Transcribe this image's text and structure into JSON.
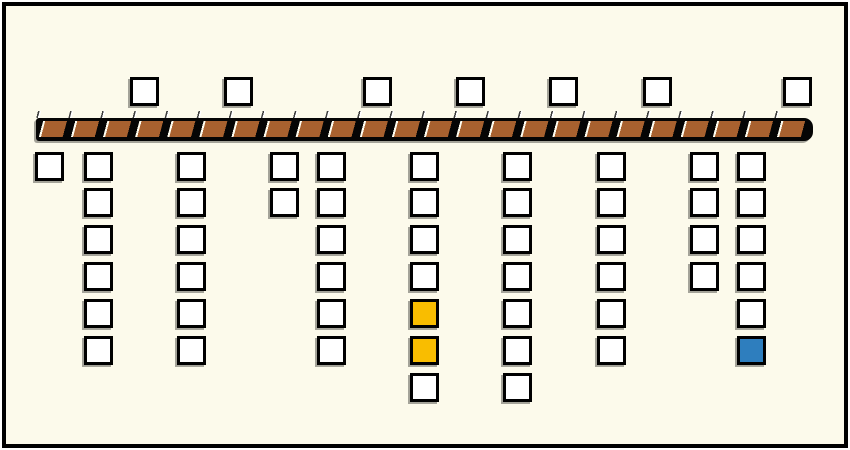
{
  "canvas": {
    "width": 850,
    "height": 450,
    "background": "#FCFAEB",
    "frame_color": "#000000",
    "outer_background": "#FFFFFF"
  },
  "colors": {
    "box_white": "#FFFFFF",
    "box_yellow": "#F9BD00",
    "box_blue": "#2E7EBE",
    "box_border": "#000000",
    "bar_brown": "#A8612F",
    "bar_black": "#050505",
    "bar_slash": "#FFFDF0",
    "shadow": "rgba(0,0,0,0.35)"
  },
  "box": {
    "size": 29,
    "border_width": 3
  },
  "bar": {
    "x": 36,
    "ticks_y": 111,
    "ticks_height": 7,
    "body_y": 118,
    "body_height": 23,
    "width": 777,
    "segment_period": 31
  },
  "boxes": [
    {
      "x": 130,
      "y": 77,
      "fill": "white"
    },
    {
      "x": 224,
      "y": 77,
      "fill": "white"
    },
    {
      "x": 363,
      "y": 77,
      "fill": "white"
    },
    {
      "x": 456,
      "y": 77,
      "fill": "white"
    },
    {
      "x": 549,
      "y": 77,
      "fill": "white"
    },
    {
      "x": 643,
      "y": 77,
      "fill": "white"
    },
    {
      "x": 783,
      "y": 77,
      "fill": "white"
    },
    {
      "x": 35,
      "y": 152,
      "fill": "white"
    },
    {
      "x": 84,
      "y": 152,
      "fill": "white"
    },
    {
      "x": 84,
      "y": 188,
      "fill": "white"
    },
    {
      "x": 84,
      "y": 225,
      "fill": "white"
    },
    {
      "x": 84,
      "y": 262,
      "fill": "white"
    },
    {
      "x": 84,
      "y": 299,
      "fill": "white"
    },
    {
      "x": 84,
      "y": 336,
      "fill": "white"
    },
    {
      "x": 177,
      "y": 152,
      "fill": "white"
    },
    {
      "x": 177,
      "y": 188,
      "fill": "white"
    },
    {
      "x": 177,
      "y": 225,
      "fill": "white"
    },
    {
      "x": 177,
      "y": 262,
      "fill": "white"
    },
    {
      "x": 177,
      "y": 299,
      "fill": "white"
    },
    {
      "x": 177,
      "y": 336,
      "fill": "white"
    },
    {
      "x": 270,
      "y": 152,
      "fill": "white"
    },
    {
      "x": 270,
      "y": 188,
      "fill": "white"
    },
    {
      "x": 317,
      "y": 152,
      "fill": "white"
    },
    {
      "x": 317,
      "y": 188,
      "fill": "white"
    },
    {
      "x": 317,
      "y": 225,
      "fill": "white"
    },
    {
      "x": 317,
      "y": 262,
      "fill": "white"
    },
    {
      "x": 317,
      "y": 299,
      "fill": "white"
    },
    {
      "x": 317,
      "y": 336,
      "fill": "white"
    },
    {
      "x": 410,
      "y": 152,
      "fill": "white"
    },
    {
      "x": 410,
      "y": 188,
      "fill": "white"
    },
    {
      "x": 410,
      "y": 225,
      "fill": "white"
    },
    {
      "x": 410,
      "y": 262,
      "fill": "white"
    },
    {
      "x": 410,
      "y": 299,
      "fill": "yellow"
    },
    {
      "x": 410,
      "y": 336,
      "fill": "yellow"
    },
    {
      "x": 410,
      "y": 373,
      "fill": "white"
    },
    {
      "x": 503,
      "y": 152,
      "fill": "white"
    },
    {
      "x": 503,
      "y": 188,
      "fill": "white"
    },
    {
      "x": 503,
      "y": 225,
      "fill": "white"
    },
    {
      "x": 503,
      "y": 262,
      "fill": "white"
    },
    {
      "x": 503,
      "y": 299,
      "fill": "white"
    },
    {
      "x": 503,
      "y": 336,
      "fill": "white"
    },
    {
      "x": 503,
      "y": 373,
      "fill": "white"
    },
    {
      "x": 597,
      "y": 152,
      "fill": "white"
    },
    {
      "x": 597,
      "y": 188,
      "fill": "white"
    },
    {
      "x": 597,
      "y": 225,
      "fill": "white"
    },
    {
      "x": 597,
      "y": 262,
      "fill": "white"
    },
    {
      "x": 597,
      "y": 299,
      "fill": "white"
    },
    {
      "x": 597,
      "y": 336,
      "fill": "white"
    },
    {
      "x": 690,
      "y": 152,
      "fill": "white"
    },
    {
      "x": 690,
      "y": 188,
      "fill": "white"
    },
    {
      "x": 690,
      "y": 225,
      "fill": "white"
    },
    {
      "x": 690,
      "y": 262,
      "fill": "white"
    },
    {
      "x": 737,
      "y": 152,
      "fill": "white"
    },
    {
      "x": 737,
      "y": 188,
      "fill": "white"
    },
    {
      "x": 737,
      "y": 225,
      "fill": "white"
    },
    {
      "x": 737,
      "y": 262,
      "fill": "white"
    },
    {
      "x": 737,
      "y": 299,
      "fill": "white"
    },
    {
      "x": 737,
      "y": 336,
      "fill": "blue"
    }
  ]
}
